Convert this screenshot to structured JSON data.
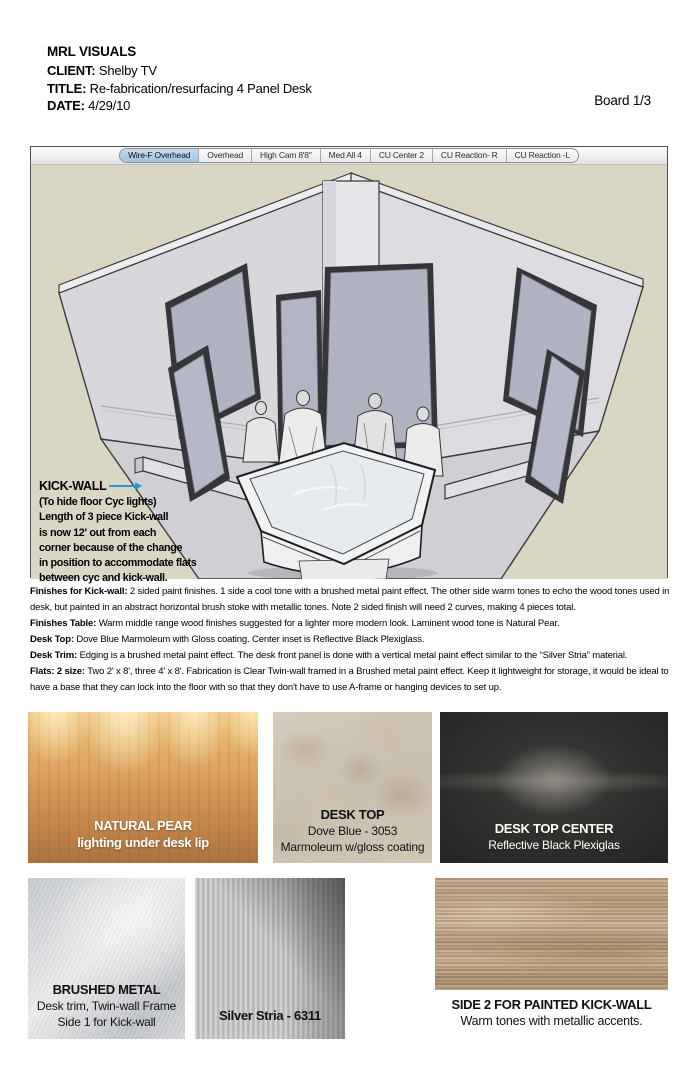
{
  "header": {
    "company": "MRL VISUALS",
    "client_label": "CLIENT:",
    "client": " Shelby TV",
    "title_label": "TITLE:",
    "title": " Re-fabrication/resurfacing 4 Panel Desk",
    "date_label": "DATE:",
    "date": " 4/29/10",
    "board": "Board 1/3"
  },
  "viewport": {
    "tabs": [
      {
        "label": "Wire-F Overhead",
        "selected": true
      },
      {
        "label": "Overhead",
        "selected": false
      },
      {
        "label": "High Cam 8'8\"",
        "selected": false
      },
      {
        "label": "Med All 4",
        "selected": false
      },
      {
        "label": "CU Center 2",
        "selected": false
      },
      {
        "label": "CU Reaction- R",
        "selected": false
      },
      {
        "label": "CU Reaction -L",
        "selected": false
      }
    ],
    "annotation": {
      "heading": "KICK-WALL",
      "lines": [
        "(To hide floor Cyc lights)",
        "Length of 3 piece Kick-wall",
        "is now 12' out from each",
        "corner because of the change",
        "in position to accommodate flats",
        "between cyc and kick-wall."
      ]
    }
  },
  "notes": [
    {
      "label": "Finishes for Kick-wall:",
      "text": " 2 sided paint finishes. 1 side a cool tone with a brushed metal paint effect. The other side warm tones to echo the wood tones used in desk, but painted in an abstract horizontal brush stoke with metallic tones. Note 2 sided finish will need 2 curves, making 4 pieces total."
    },
    {
      "label": "Finishes Table:",
      "text": " Warm middle range wood finishes suggested for a lighter more modern look. Laminent wood tone is Natural Pear."
    },
    {
      "label": "Desk Top:",
      "text": " Dove Blue Marmoleum with Gloss coating. Center inset is Reflective Black Plexiglass."
    },
    {
      "label": "Desk Trim:",
      "text": " Edging is a brushed metal paint effect. The desk front panel is done with a vertical metal paint effect similar to the “Silver Stria” material."
    },
    {
      "label": "Flats: 2 size:",
      "text": " Two 2' x 8', three 4' x 8'. Fabrication is Clear Twin-wall framed in a Brushed metal paint effect. Keep it lightweight for storage, it would be ideal to have a base that they can lock into the floor with so that they don't have to use A-frame or hanging devices to set up."
    }
  ],
  "swatches": {
    "natural_pear": {
      "line1": "NATURAL PEAR",
      "line2": "lighting under desk lip"
    },
    "desk_top": {
      "line1": "DESK TOP",
      "line2": "Dove Blue - 3053",
      "line3": "Marmoleum w/gloss coating"
    },
    "desk_top_center": {
      "line1": "DESK TOP CENTER",
      "line2": "Reflective Black Plexiglas"
    },
    "brushed_metal": {
      "line1": "BRUSHED METAL",
      "line2": "Desk trim, Twin-wall Frame",
      "line3": "Side 1 for Kick-wall"
    },
    "silver_stria": {
      "line1": "Silver Stria - 6311"
    },
    "side2_kick_wall": {
      "line1": "SIDE 2 FOR PAINTED KICK-WALL",
      "line2": "Warm tones with metallic accents."
    }
  },
  "colors": {
    "annotation_arrow": "#2299d5",
    "tab_selected": "#a9c8e8",
    "viewport_background": "#d9d6c3",
    "wall_gray": "#d8d8dc",
    "floor_gray": "#cfcfd4"
  }
}
